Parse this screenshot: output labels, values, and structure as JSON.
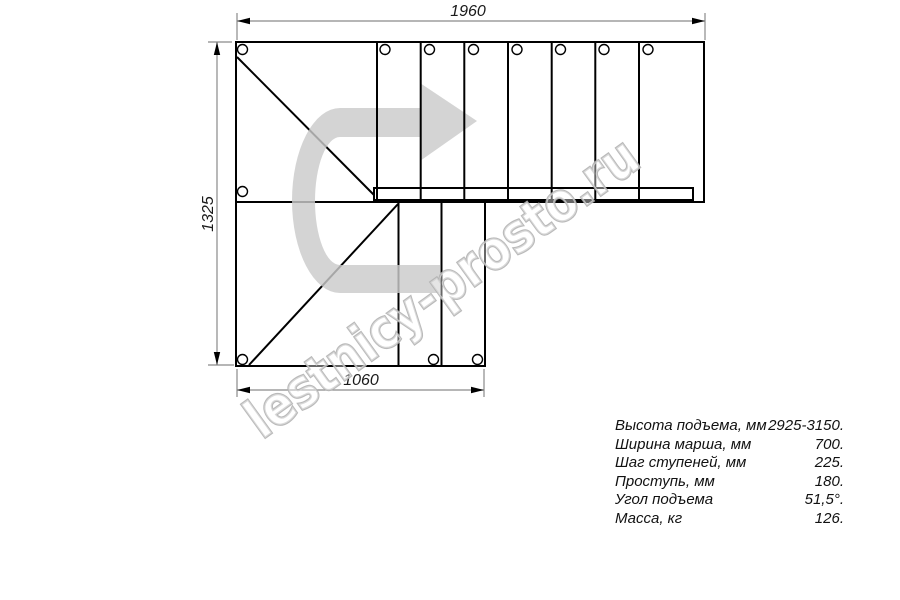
{
  "dimensions": {
    "top": "1960",
    "left": "1325",
    "bottom": "1060"
  },
  "specs": {
    "rows": [
      {
        "label": "Высота подъема, мм",
        "value": "2925-3150."
      },
      {
        "label": "Ширина марша, мм",
        "value": "700."
      },
      {
        "label": "Шаг ступеней, мм",
        "value": "225."
      },
      {
        "label": "Проступь, мм",
        "value": "180."
      },
      {
        "label": "Угол подъема",
        "value": "51,5°."
      },
      {
        "label": "Масса, кг",
        "value": "126."
      }
    ]
  },
  "watermark": {
    "text": "lestnicy-prosto.ru"
  },
  "icons": {
    "direction_arrow": "u-turn-right-arrow-icon"
  },
  "colors": {
    "background": "#ffffff",
    "drawing_line": "#000000",
    "dimension_line": "#8a8a8a",
    "direction_arrow_fill": "#d5d5d5",
    "watermark_stroke": "#b3b3b3"
  }
}
